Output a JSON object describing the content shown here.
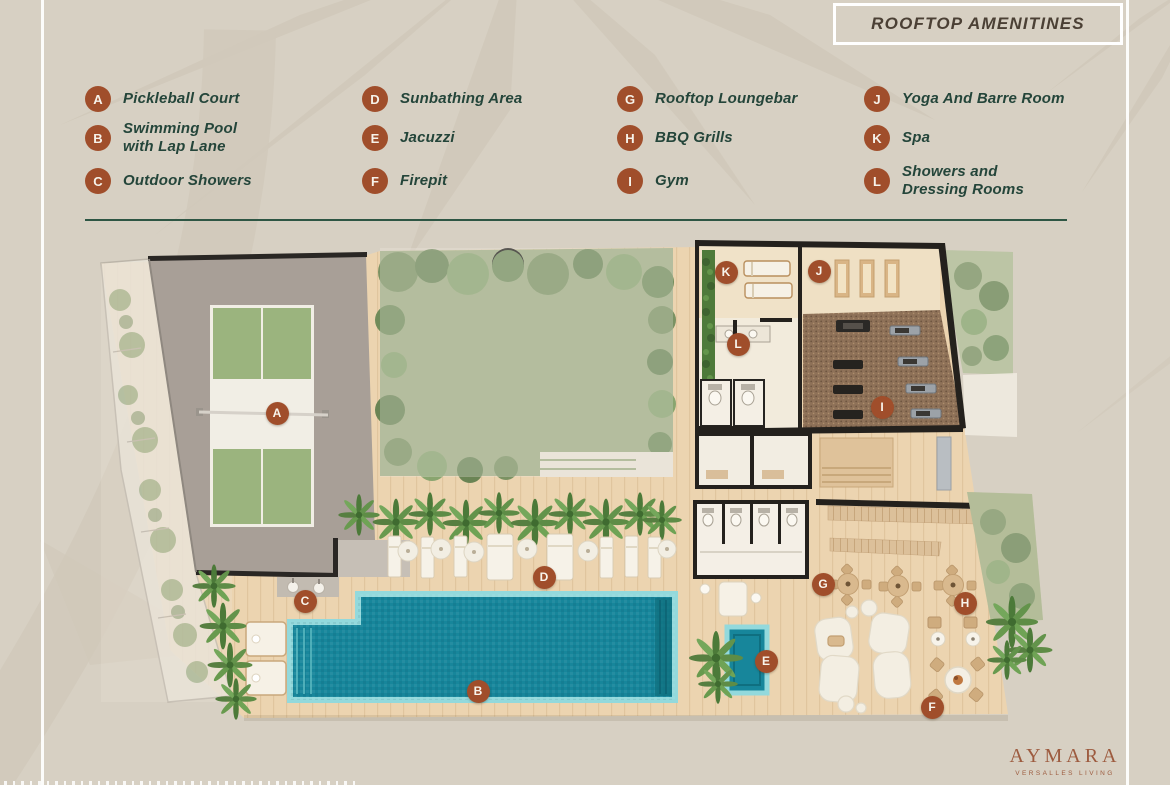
{
  "title": {
    "text": "ROOFTOP AMENITINES"
  },
  "legend": {
    "items": [
      {
        "letter": "A",
        "label": "Pickleball Court"
      },
      {
        "letter": "B",
        "label": "Swimming Pool\nwith Lap Lane"
      },
      {
        "letter": "C",
        "label": "Outdoor Showers"
      },
      {
        "letter": "D",
        "label": "Sunbathing Area"
      },
      {
        "letter": "E",
        "label": "Jacuzzi"
      },
      {
        "letter": "F",
        "label": "Firepit"
      },
      {
        "letter": "G",
        "label": "Rooftop Loungebar"
      },
      {
        "letter": "H",
        "label": "BBQ Grills"
      },
      {
        "letter": "I",
        "label": "Gym"
      },
      {
        "letter": "J",
        "label": "Yoga And  Barre Room"
      },
      {
        "letter": "K",
        "label": "Spa"
      },
      {
        "letter": "L",
        "label": "Showers and\nDressing Rooms"
      }
    ]
  },
  "plan": {
    "markers": [
      {
        "letter": "A"
      },
      {
        "letter": "B"
      },
      {
        "letter": "C"
      },
      {
        "letter": "D"
      },
      {
        "letter": "E"
      },
      {
        "letter": "F"
      },
      {
        "letter": "G"
      },
      {
        "letter": "H"
      },
      {
        "letter": "I"
      },
      {
        "letter": "J"
      },
      {
        "letter": "K"
      },
      {
        "letter": "L"
      }
    ]
  },
  "brand": {
    "name": "AYMARA",
    "tagline": "VERSALLES LIVING"
  },
  "colors": {
    "background": "#D7D0C3",
    "accent_rust": "#A04E2B",
    "legend_text": "#24453A",
    "divider_green": "#2E5644",
    "title_text": "#4B4035",
    "pool_teal": "#17869B",
    "brand_rust": "#9D5B3F"
  }
}
